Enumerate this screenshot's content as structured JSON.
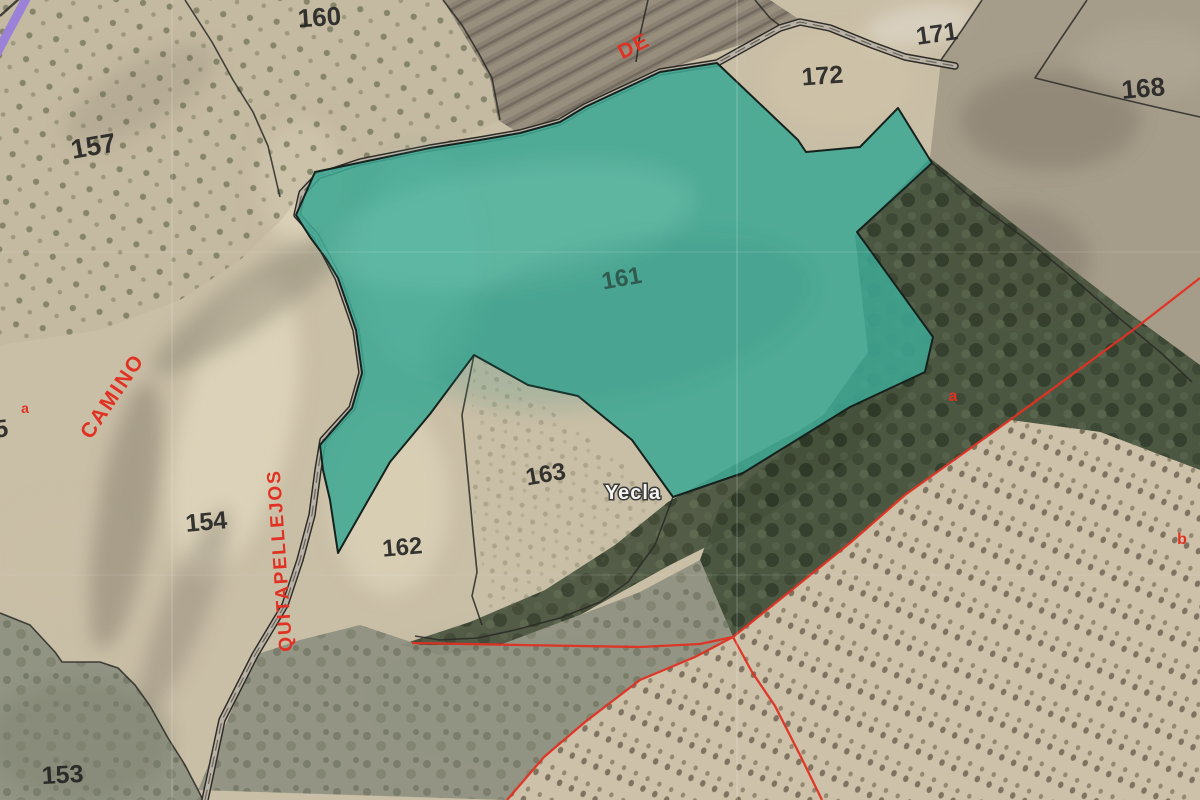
{
  "map": {
    "place": {
      "town": "Yecla"
    },
    "road": {
      "part1": "CAMINO",
      "part2": "DE",
      "part3": "QUITAPELLEJOS"
    },
    "parcels": {
      "p153": "153",
      "p154": "154",
      "p157": "157",
      "p160": "160",
      "p161": "161",
      "p162": "162",
      "p163": "163",
      "p168": "168",
      "p171": "171",
      "p172": "172",
      "edge_partial": "5"
    },
    "subparcels": {
      "a_west": "a",
      "a_east": "a",
      "b_east": "b"
    },
    "selected_parcel": {
      "number": "161",
      "fill": "#3EA893"
    },
    "colors": {
      "boundary_red": "#E03122",
      "label_black": "#1E1E1E",
      "highlight_teal": "#3EA893",
      "corner_purple": "#9B82D8"
    }
  }
}
